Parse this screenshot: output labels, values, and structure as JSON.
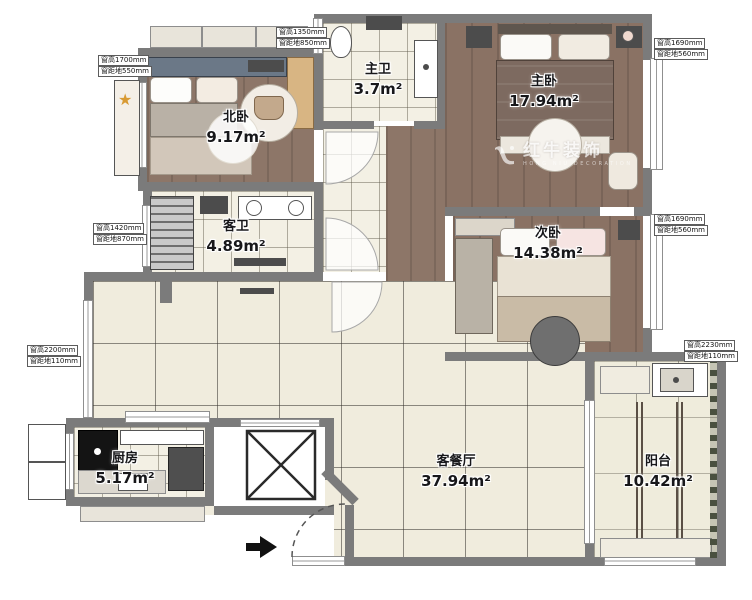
{
  "plan_title": "apartment-floor-plan",
  "watermark": {
    "brand": "红牛装饰",
    "sub": "HONG NIU DECORATION"
  },
  "rooms": {
    "north_bedroom": {
      "name": "北卧",
      "area": "9.17m²"
    },
    "master_bath": {
      "name": "主卫",
      "area": "3.7m²"
    },
    "master_bedroom": {
      "name": "主卧",
      "area": "17.94m²"
    },
    "guest_bath": {
      "name": "客卫",
      "area": "4.89m²"
    },
    "second_bedroom": {
      "name": "次卧",
      "area": "14.38m²"
    },
    "kitchen": {
      "name": "厨房",
      "area": "5.17m²"
    },
    "living_dining": {
      "name": "客餐厅",
      "area": "37.94m²"
    },
    "balcony": {
      "name": "阳台",
      "area": "10.42m²"
    }
  },
  "window_tags": {
    "left_top": {
      "line1": "窗高1700mm",
      "line2": "窗距地550mm"
    },
    "top": {
      "line1": "窗高1350mm",
      "line2": "窗距地850mm"
    },
    "right_top": {
      "line1": "窗高1690mm",
      "line2": "窗距地560mm"
    },
    "right_mid": {
      "line1": "窗高1690mm",
      "line2": "窗距地560mm"
    },
    "right_bottom": {
      "line1": "窗高2230mm",
      "line2": "窗距地110mm"
    },
    "left_mid": {
      "line1": "窗高1420mm",
      "line2": "窗距地870mm"
    },
    "left_bottom": {
      "line1": "窗高2200mm",
      "line2": "窗距地110mm"
    }
  },
  "icons": {
    "entry_arrow": "entry-direction-arrow",
    "elevator_cross": "elevator-shaft-x",
    "cat_tree_star": "star"
  },
  "colors": {
    "wall": "#7b7b7b",
    "tile_floor": "#f0ecdd",
    "wood_floor": "#8d7668",
    "fixture_white": "#ffffff",
    "star_accent": "#d89a33"
  }
}
